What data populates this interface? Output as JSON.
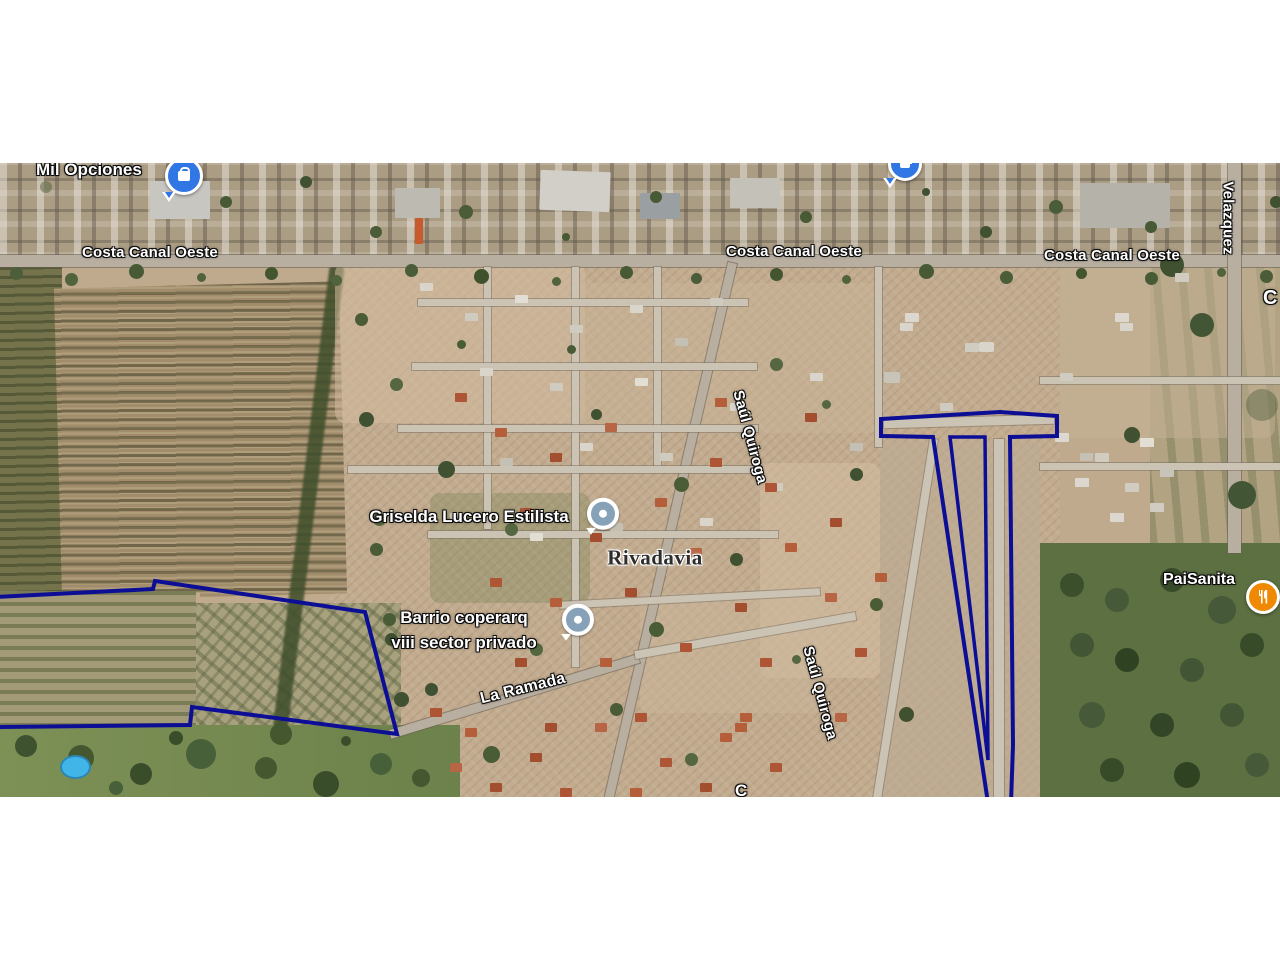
{
  "streets": {
    "costa_canal_oeste": "Costa Canal Oeste",
    "velazquez": "Velazquez",
    "saul_quiroga": "Saúl Quiroga",
    "la_ramada": "La Ramada",
    "partial_letter_right": "C",
    "partial_letter_bottom": "C"
  },
  "places": {
    "locality": "Rivadavia"
  },
  "pois": {
    "mil_opciones": "Mil Opciones",
    "griselda": "Griselda Lucero Estilista",
    "barrio_line1": "Barrio coperarq",
    "barrio_line2": "viii sector privado",
    "paisanita": "PaiSanita"
  },
  "colors": {
    "parcel_boundary": "#0c0e95",
    "poi_pin_blue": "#3076e5",
    "poi_restaurant_orange": "#ef8903",
    "poi_generic_dot": "#87a2b8",
    "letterbox": "#ffffff"
  }
}
